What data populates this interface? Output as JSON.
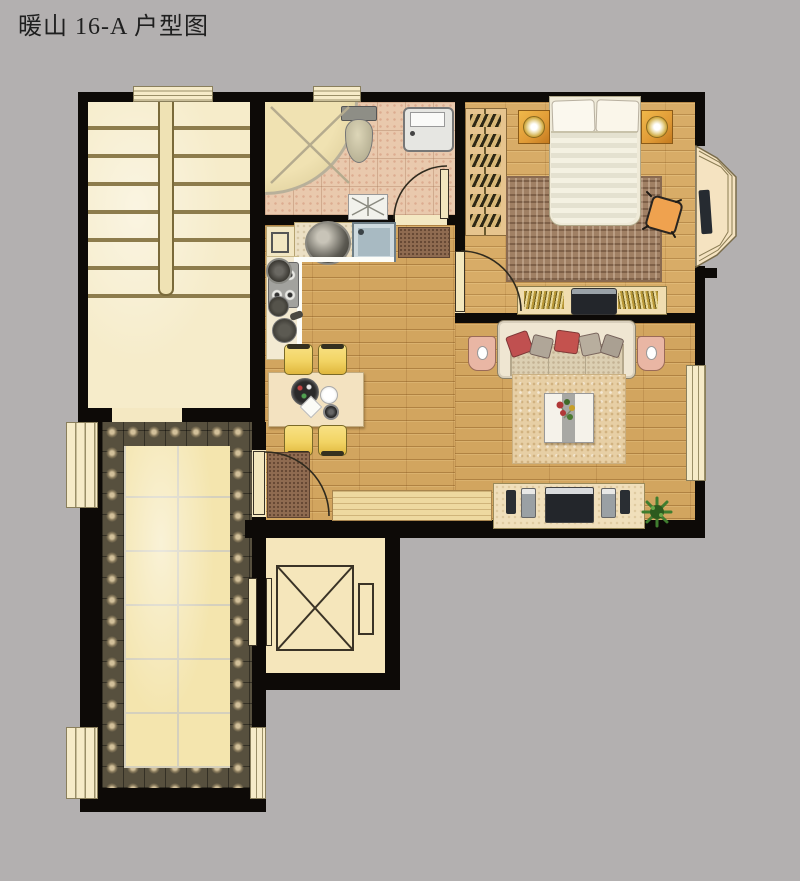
{
  "title": "暖山 16-A 户型图",
  "colors": {
    "background": "#b3b0b0",
    "wall": "#0d0a07",
    "cream": "#f6ebc8",
    "stair": "#f6ecca",
    "wood-floor": "#d2a55f",
    "bedroom-floor": "#d8ac67",
    "bathroom-tile": "#e9c9ad",
    "terrace-tile": "#f4e5ae",
    "terrace-border": "#57503e",
    "chair-yellow": "#f2d464",
    "sofa-cream": "#efe6d2",
    "pillow-red": "#c05050",
    "armchair-pink": "#e9b6a4",
    "nightstand-orange": "#e09a36",
    "plant-green": "#3f7d2f",
    "tv-dark": "#23262b"
  }
}
